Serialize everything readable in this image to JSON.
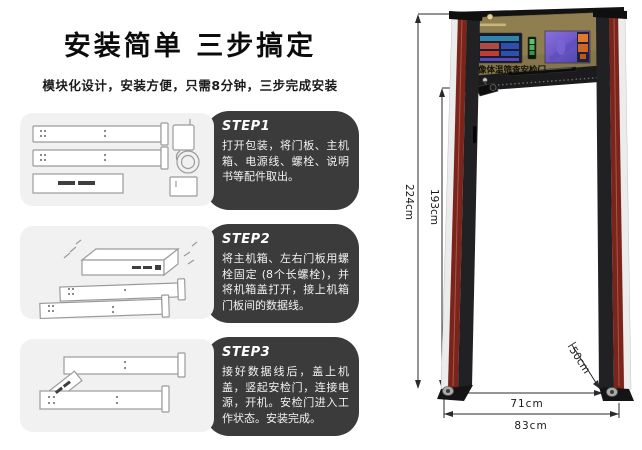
{
  "header": {
    "title": "安装简单 三步搞定",
    "subtitle": "模块化设计，安装方便，只需8分钟，三步完成安装"
  },
  "steps": [
    {
      "label": "STEP1",
      "text": "打开包装，将门板、主机箱、电源线、螺栓、说明书等配件取出。"
    },
    {
      "label": "STEP2",
      "text": "将主机箱、左右门板用螺栓固定 (8个长螺栓)，并将机箱盖打开，接上机箱门板间的数据线。"
    },
    {
      "label": "STEP3",
      "text": "接好数据线后，盖上机盖，竖起安检门，连接电源，开机。安检门进入工作状态。安装完成。"
    }
  ],
  "gate": {
    "panel_title": "热成像体温筛查安检门",
    "dims": {
      "total_height": "224cm",
      "inner_height": "193cm",
      "base_depth": "50cm",
      "inner_width": "71cm",
      "outer_width": "83cm"
    }
  },
  "colors": {
    "step_box": "#3b3b3b",
    "panel_gray": "#f1f1f1",
    "header_gold": "#8f7e50",
    "pillar_red": "#7b241b",
    "pillar_dark": "#212124",
    "led_green": "#43b457",
    "screen_navy": "#151d33",
    "screen_purple": "#6c57c6"
  }
}
